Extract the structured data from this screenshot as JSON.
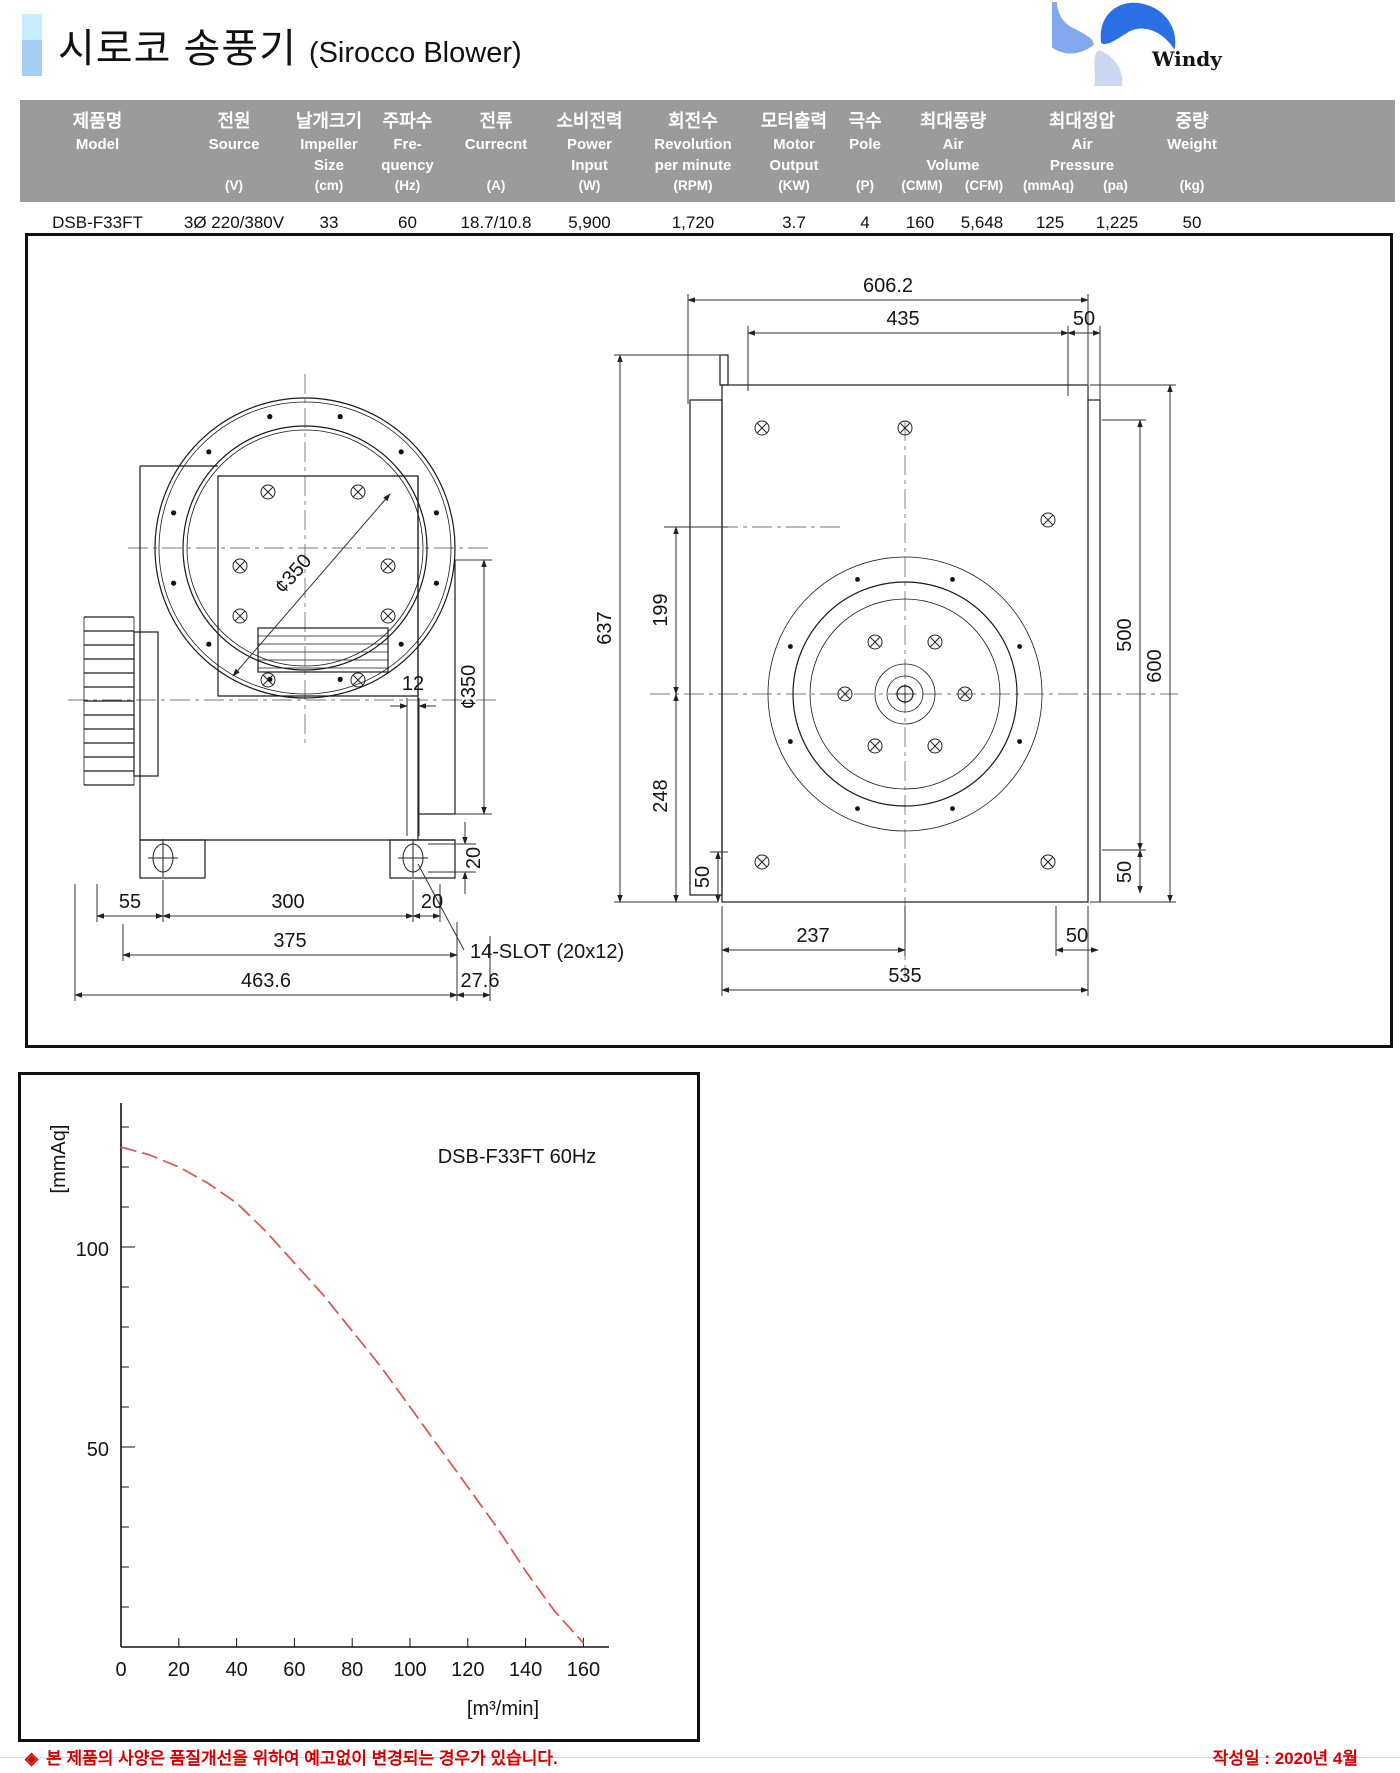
{
  "page": {
    "title_kr": "시로코 송풍기",
    "title_en": "(Sirocco Blower)",
    "brand": "Windy",
    "footer_bullet": "◈",
    "footer_note": "본 제품의 사양은 품질개선을 위하여 예고없이 변경되는 경우가 있습니다.",
    "footer_date": "작성일 : 2020년 4월",
    "brand_color": "#1a4fd0",
    "accent_red": "#d40000"
  },
  "spec_table": {
    "columns": {
      "model": {
        "kr": "제품명",
        "en1": "Model",
        "en2": "",
        "unit": ""
      },
      "source": {
        "kr": "전원",
        "en1": "Source",
        "en2": "",
        "unit": "(V)"
      },
      "impeller": {
        "kr": "날개크기",
        "en1": "Impeller",
        "en2": "Size",
        "unit": "(cm)"
      },
      "freq": {
        "kr": "주파수",
        "en1": "Fre-",
        "en2": "quency",
        "unit": "(Hz)"
      },
      "current": {
        "kr": "전류",
        "en1": "Currecnt",
        "en2": "",
        "unit": "(A)"
      },
      "power": {
        "kr": "소비전력",
        "en1": "Power",
        "en2": "Input",
        "unit": "(W)"
      },
      "rpm": {
        "kr": "회전수",
        "en1": "Revolution",
        "en2": "per minute",
        "unit": "(RPM)"
      },
      "motor": {
        "kr": "모터출력",
        "en1": "Motor",
        "en2": "Output",
        "unit": "(KW)"
      },
      "pole": {
        "kr": "극수",
        "en1": "Pole",
        "en2": "",
        "unit": "(P)"
      },
      "airvol": {
        "kr": "최대풍량",
        "en1": "Air",
        "en2": "Volume",
        "unit": "(CMM)",
        "unit2": "(CFM)"
      },
      "airpress": {
        "kr": "최대정압",
        "en1": "Air",
        "en2": "Pressure",
        "unit": "(mmAq)",
        "unit2": "(pa)"
      },
      "weight": {
        "kr": "중량",
        "en1": "Weight",
        "en2": "",
        "unit": "(kg)"
      }
    },
    "row": {
      "model": "DSB-F33FT",
      "source": "3Ø 220/380V",
      "impeller": "33",
      "frequency": "60",
      "current": "18.7/10.8",
      "power": "5,900",
      "rpm": "1,720",
      "motor": "3.7",
      "pole": "4",
      "cmm": "160",
      "cfm": "5,648",
      "mmaq": "125",
      "pa": "1,225",
      "weight": "50"
    }
  },
  "drawings": {
    "left_view": {
      "inlet_diameter": "¢350",
      "outlet_diameter": "¢350",
      "slot_width": "12",
      "slot_height": "20",
      "dim_55": "55",
      "dim_300": "300",
      "dim_20": "20",
      "dim_375": "375",
      "slot_note": "14-SLOT (20x12)",
      "dim_463_6": "463.6",
      "dim_27_6": "27.6"
    },
    "right_view": {
      "dim_606_2": "606.2",
      "dim_435": "435",
      "dim_50_top": "50",
      "dim_637": "637",
      "dim_199": "199",
      "dim_248": "248",
      "dim_50_left": "50",
      "dim_500": "500",
      "dim_600": "600",
      "dim_50_right": "50",
      "dim_237": "237",
      "dim_50_bottom": "50",
      "dim_535": "535"
    }
  },
  "chart_data": {
    "type": "line",
    "title": "DSB-F33FT 60Hz",
    "xlabel": "[m³/min]",
    "ylabel": "[mmAq]",
    "x_ticks": [
      0,
      20,
      40,
      60,
      80,
      100,
      120,
      140,
      160
    ],
    "y_ticks": [
      50,
      100
    ],
    "xlim": [
      0,
      169
    ],
    "ylim": [
      0,
      136
    ],
    "grid": false,
    "legend_position": "none",
    "curve_color": "#e05050",
    "line_style": "dashed",
    "series": [
      {
        "name": "static pressure curve",
        "points": [
          [
            0,
            125
          ],
          [
            10,
            123
          ],
          [
            20,
            120
          ],
          [
            30,
            116
          ],
          [
            40,
            111
          ],
          [
            50,
            104
          ],
          [
            60,
            96
          ],
          [
            70,
            88
          ],
          [
            80,
            79
          ],
          [
            90,
            70
          ],
          [
            100,
            60
          ],
          [
            110,
            50
          ],
          [
            120,
            40
          ],
          [
            130,
            30
          ],
          [
            140,
            19
          ],
          [
            150,
            9
          ],
          [
            160,
            1
          ]
        ]
      }
    ]
  }
}
